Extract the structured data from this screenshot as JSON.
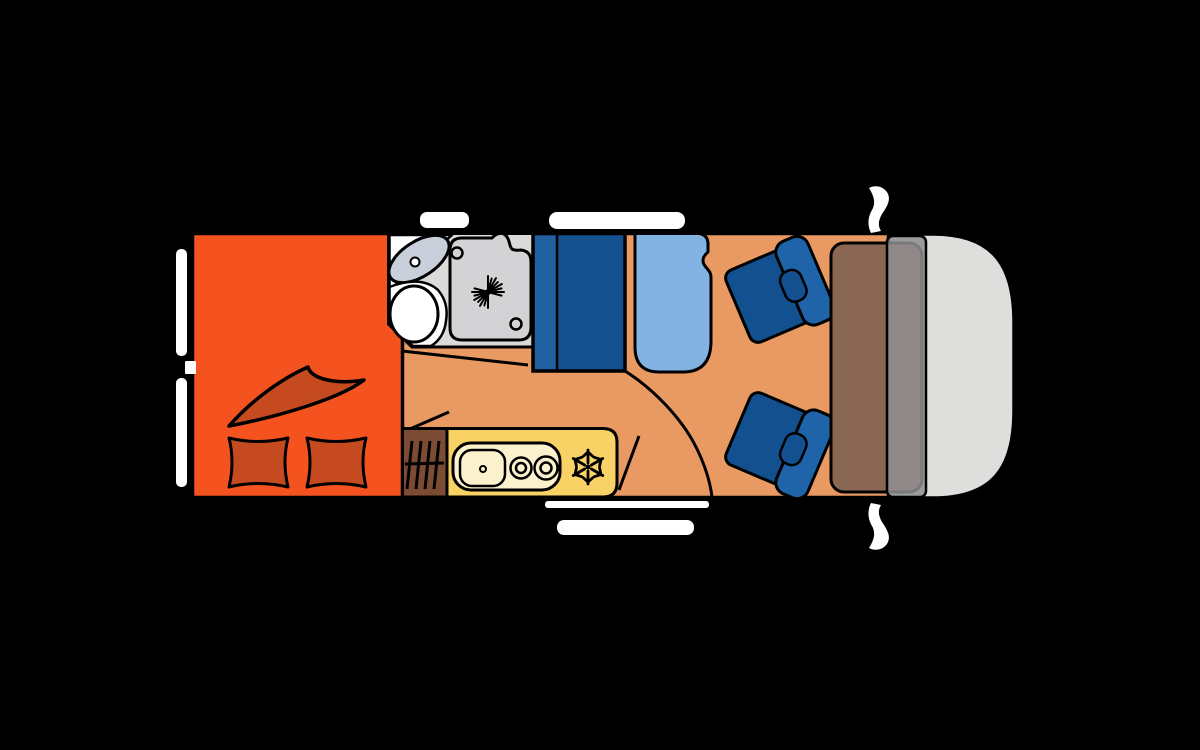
{
  "plan": {
    "type": "campervan-floorplan",
    "areas": [
      {
        "name": "rear-bed",
        "features": [
          "duvet",
          "pillow-left",
          "pillow-right"
        ]
      },
      {
        "name": "bathroom",
        "features": [
          "washbasin",
          "basin-drain",
          "toilet",
          "shower-tray",
          "shower-drain-star"
        ]
      },
      {
        "name": "wardrobe-bench",
        "features": [
          "bench-cushion-strip"
        ]
      },
      {
        "name": "dinette",
        "features": [
          "table"
        ]
      },
      {
        "name": "kitchen",
        "features": [
          "heater-grill",
          "sink",
          "burner-front",
          "burner-rear",
          "fridge-snowflake"
        ]
      },
      {
        "name": "cab",
        "features": [
          "swivel-seat-left",
          "swivel-seat-right",
          "dashboard",
          "windshield",
          "mirror-top",
          "mirror-bottom"
        ]
      }
    ],
    "openings": {
      "roof-window-marks-top": 2,
      "side-window-marks-left": 2,
      "window-latch-mark-left": 1,
      "entry-door-marks-bottom": 2,
      "door-swing-lines": 4
    },
    "kitchen": {
      "burner_count": 2
    }
  },
  "icons": {
    "fridge": "snowflake-icon",
    "shower_drain": "drain-star-icon",
    "heater": "heater-grill-icon"
  },
  "colors": {
    "background": "#000000",
    "outline": "#000000",
    "white": "#FFFFFF",
    "bed": "#F4531F",
    "bedding": "#C64A1F",
    "floor": "#E99A62",
    "bathroom": "#DADADA",
    "shower_tray": "#D3D3D5",
    "sink_basin": "#C8CEDA",
    "fixture_white": "#FFFFFF",
    "bench_dark": "#12508F",
    "bench_light": "#2161A1",
    "table": "#83B3E3",
    "seat_dark": "#12508F",
    "seat_light": "#1F64A8",
    "kitchen": "#F8D265",
    "kitchen_panel": "#FBF2CD",
    "heater": "#7B4B34",
    "dashboard": "#8A6753",
    "windshield": "#8F8F91",
    "cab_body": "#DEDEDC",
    "symbol": "#000000"
  }
}
